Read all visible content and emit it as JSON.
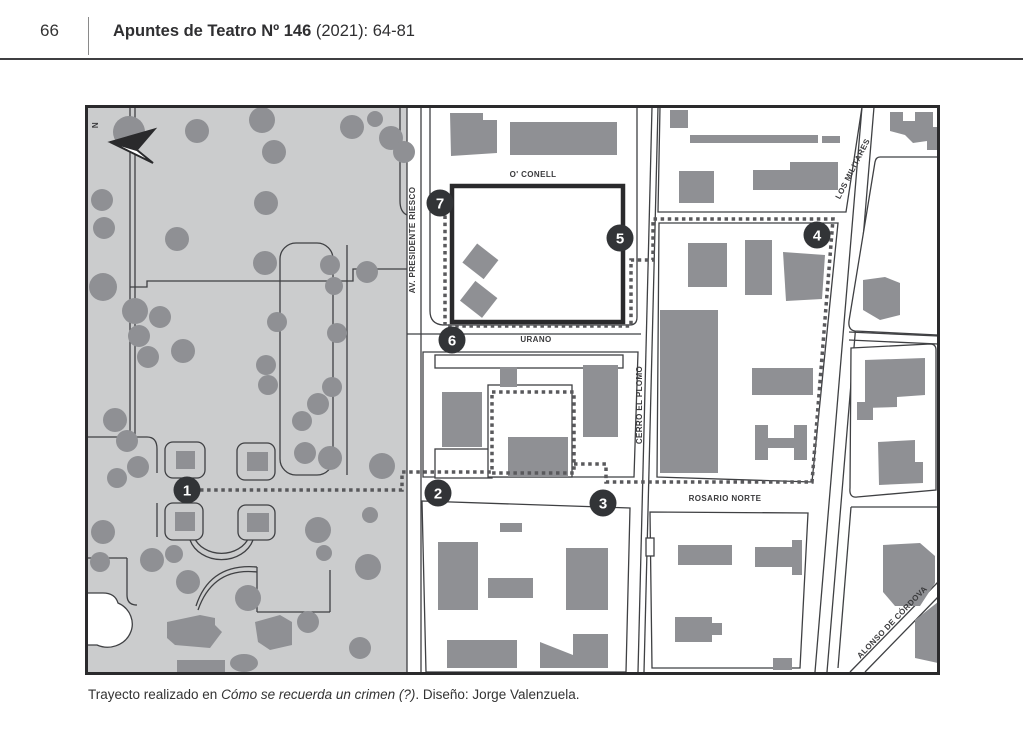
{
  "page": {
    "page_number": "66",
    "header": {
      "title_bold": "Apuntes de Teatro Nº 146",
      "title_rest": " (2021): 64-81"
    },
    "caption": {
      "prefix": "Trayecto realizado en ",
      "work_title": "Cómo se recuerda un crimen (?)",
      "suffix": ". Diseño: Jorge Valenzuela."
    }
  },
  "map": {
    "compass": "N",
    "streets": {
      "oconell": "O' CONELL",
      "presidente_riesco": "AV. PRESIDENTE RIESCO",
      "urano": "URANO",
      "cerro_el_plomo": "CERRO EL PLOMO",
      "rosario_norte": "ROSARIO NORTE",
      "los_militares": "LOS MILITARES",
      "alonso_de_cordova": "ALONSO DE CÓRDOVA"
    },
    "markers": {
      "m1": "1",
      "m2": "2",
      "m3": "3",
      "m4": "4",
      "m5": "5",
      "m6": "6",
      "m7": "7"
    },
    "colors": {
      "park": "#cbcccd",
      "building": "#8f9094",
      "outline": "#3f4043",
      "frame": "#2a2a2c",
      "route_dots": "#59595c",
      "marker_fill": "#323437",
      "marker_number": "#ffffff"
    }
  }
}
